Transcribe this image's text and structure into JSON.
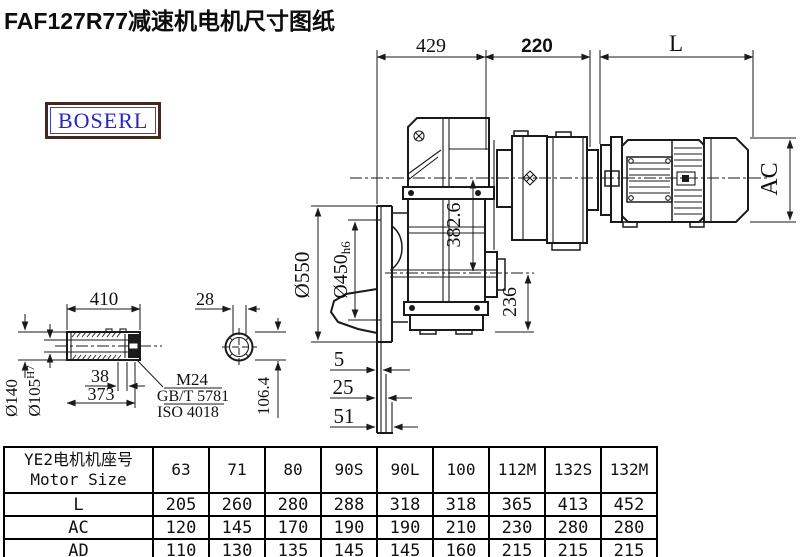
{
  "title": "FAF127R77减速机电机尺寸图纸",
  "brand": "BOSERL",
  "drawing": {
    "dims": {
      "width_429": "429",
      "width_220": "220",
      "motor_length": "L",
      "motor_height": "AC",
      "flange_od": "Ø550",
      "spigot_main": "Ø450",
      "spigot_tol": "h6",
      "center_height": "382.6",
      "v236": "236",
      "gap5": "5",
      "gap25": "25",
      "gap51": "51",
      "shaft_len": "410",
      "shaft_od": "Ø140",
      "bore_main": "Ø105",
      "bore_tol": "H7",
      "d38": "38",
      "d373": "373",
      "thread": "M24",
      "standard_gb": "GB/T 5781",
      "standard_iso": "ISO 4018",
      "key_width": "28",
      "h106": "106.4"
    }
  },
  "table": {
    "header_cn": "YE2电机机座号",
    "header_en": "Motor Size",
    "columns": [
      "63",
      "71",
      "80",
      "90S",
      "90L",
      "100",
      "112M",
      "132S",
      "132M"
    ],
    "rows": [
      {
        "label": "L",
        "values": [
          "205",
          "260",
          "280",
          "288",
          "318",
          "318",
          "365",
          "413",
          "452"
        ]
      },
      {
        "label": "AC",
        "values": [
          "120",
          "145",
          "170",
          "190",
          "190",
          "210",
          "230",
          "280",
          "280"
        ]
      },
      {
        "label": "AD",
        "values": [
          "110",
          "130",
          "135",
          "145",
          "145",
          "160",
          "215",
          "215",
          "215"
        ]
      }
    ]
  }
}
